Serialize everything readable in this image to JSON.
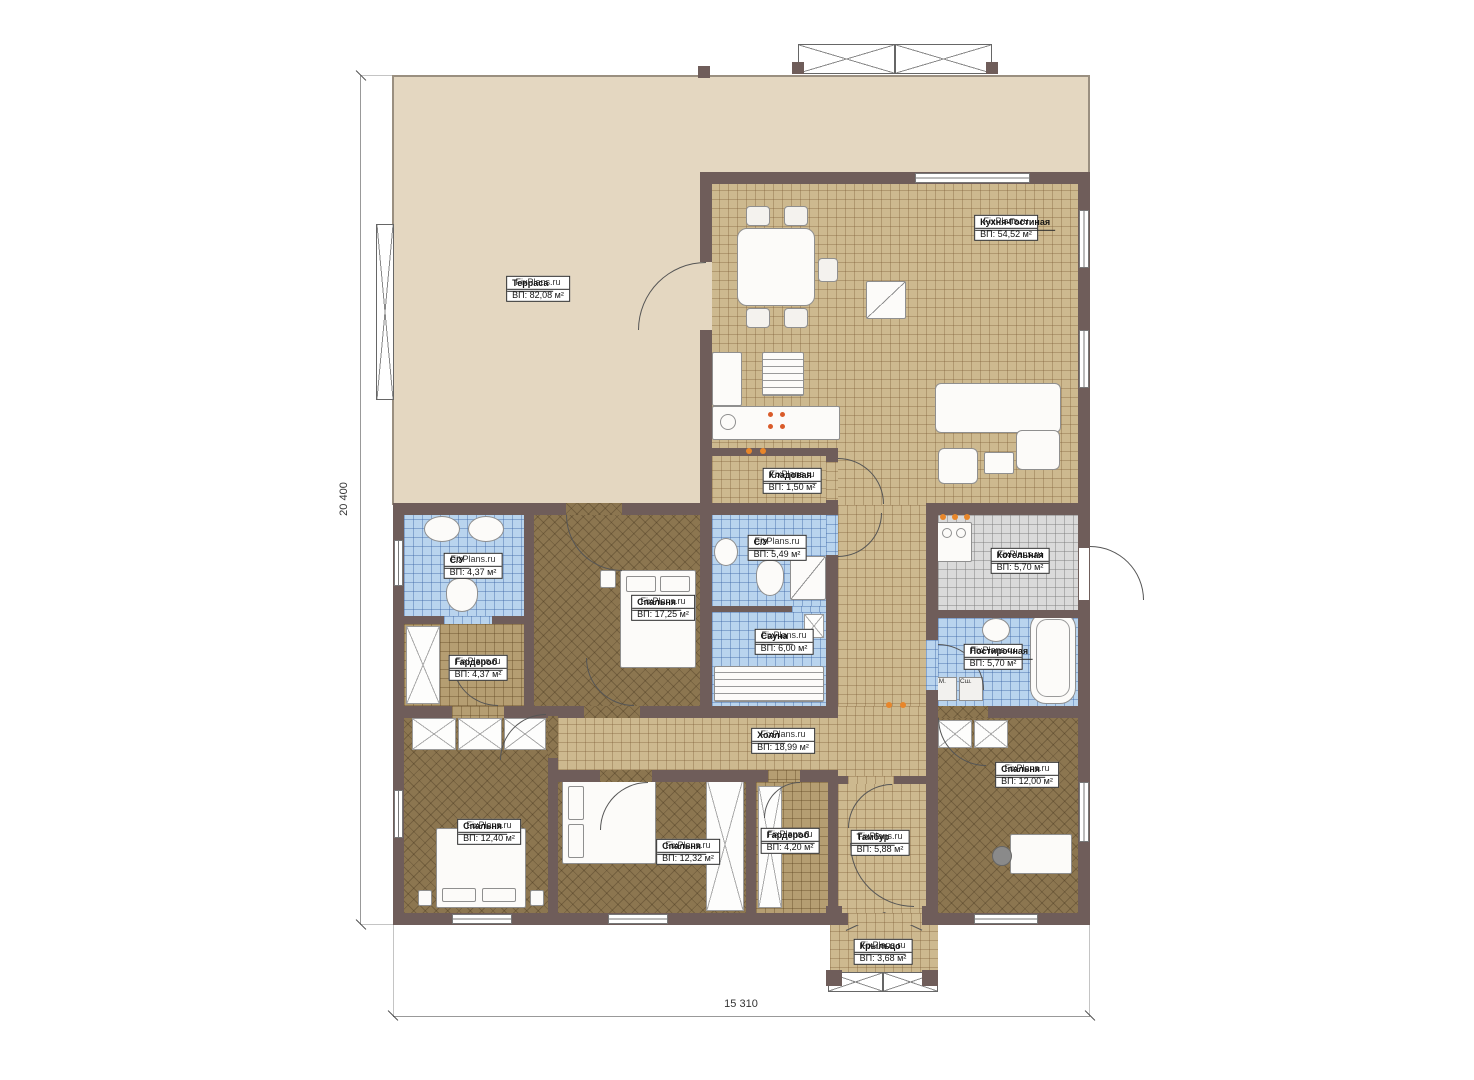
{
  "meta": {
    "type": "floor-plan",
    "brand": "FixPlans.ru"
  },
  "dimensions": {
    "height": "20 400",
    "width": "15 310"
  },
  "rooms": [
    {
      "name": "Терраса",
      "brand": "FixPlans.ru",
      "area": "ВП: 82,08 м²"
    },
    {
      "name": "Кухня-Гостиная",
      "brand": "FixPlans.ru",
      "area": "ВП: 54,52 м²"
    },
    {
      "name": "Кладовая",
      "brand": "FixPlans.ru",
      "area": "ВП: 1,50 м²"
    },
    {
      "name": "С/У",
      "brand": "FixPlans.ru",
      "area": "ВП: 4,37 м²"
    },
    {
      "name": "С/У",
      "brand": "FixPlans.ru",
      "area": "ВП: 5,49 м²"
    },
    {
      "name": "Котельная",
      "brand": "FixPlans.ru",
      "area": "ВП: 5,70 м²"
    },
    {
      "name": "Спальня",
      "brand": "FixPlans.ru",
      "area": "ВП: 17,25 м²"
    },
    {
      "name": "Сауна",
      "brand": "FixPlans.ru",
      "area": "ВП: 6,00 м²"
    },
    {
      "name": "Гардероб",
      "brand": "FixPlans.ru",
      "area": "ВП: 4,37 м²"
    },
    {
      "name": "Постирочная",
      "brand": "FixPlans.ru",
      "area": "ВП: 5,70 м²"
    },
    {
      "name": "Холл",
      "brand": "FixPlans.ru",
      "area": "ВП: 18,99 м²"
    },
    {
      "name": "Спальня",
      "brand": "FixPlans.ru",
      "area": "ВП: 12,40 м²"
    },
    {
      "name": "Спальня",
      "brand": "FixPlans.ru",
      "area": "ВП: 12,32 м²"
    },
    {
      "name": "Гардероб",
      "brand": "FixPlans.ru",
      "area": "ВП: 4,20 м²"
    },
    {
      "name": "Тамбур",
      "brand": "FixPlans.ru",
      "area": "ВП: 5,88 м²"
    },
    {
      "name": "Спальня",
      "brand": "FixPlans.ru",
      "area": "ВП: 12,00 м²"
    },
    {
      "name": "Крыльцо",
      "brand": "FixPlans.ru",
      "area": "ВП: 3,68 м²"
    }
  ],
  "appliances": {
    "washer": "Ст.М.",
    "dryer": "Сш."
  },
  "colors": {
    "wall": "#6f5d5a",
    "terrace": "#e4d7c1",
    "tile_tan": "#cdb98f",
    "tile_blue": "#b9d4ee",
    "tile_gray": "#dadada",
    "parquet": "#8c7650",
    "door_marker": "#e8862a"
  }
}
